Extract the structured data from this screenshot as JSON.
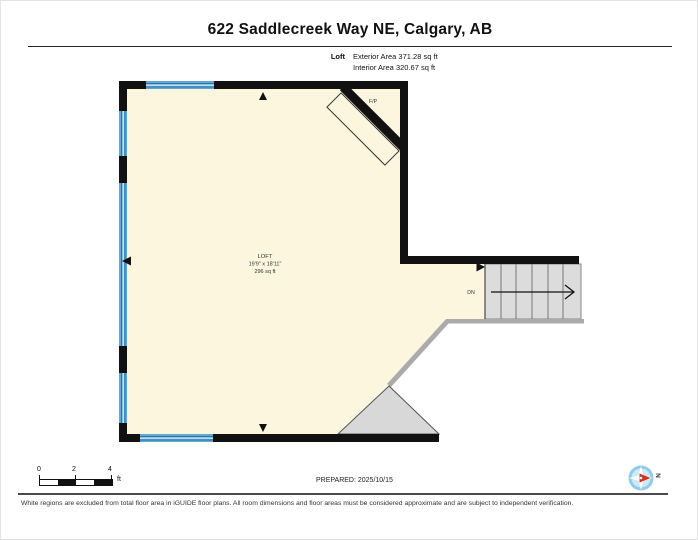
{
  "header": {
    "title": "622 Saddlecreek Way NE, Calgary, AB",
    "floor_label": "Loft",
    "exterior_area": "Exterior Area 371.28 sq ft",
    "interior_area": "Interior Area 320.67 sq ft"
  },
  "plan": {
    "room_name": "LOFT",
    "room_dimensions": "19'9\" x 18'11\"",
    "room_area": "296 sq ft",
    "fireplace_label": "F/P",
    "stair_label": "DN"
  },
  "scale_bar": {
    "tick_0": "0",
    "tick_2": "2",
    "tick_4": "4",
    "unit": "ft"
  },
  "footer": {
    "prepared": "PREPARED: 2025/10/15",
    "compass_north": "N",
    "disclaimer": "White regions are excluded from total floor area in iGUIDE floor plans. All room dimensions and floor areas must be considered approximate and are subject to independent verification."
  },
  "colors": {
    "wall": "#111111",
    "floor": "#FCF6DF",
    "window_blue": "#5FA8D5",
    "window_dark": "#2F76A6",
    "window_light": "#D6EAF5",
    "stair_fill": "#DCDCDC",
    "gray_wall": "#ABABAB",
    "void_fill": "#D8D8D8",
    "compass_blue": "#8FCBEA",
    "compass_red": "#D93025"
  }
}
